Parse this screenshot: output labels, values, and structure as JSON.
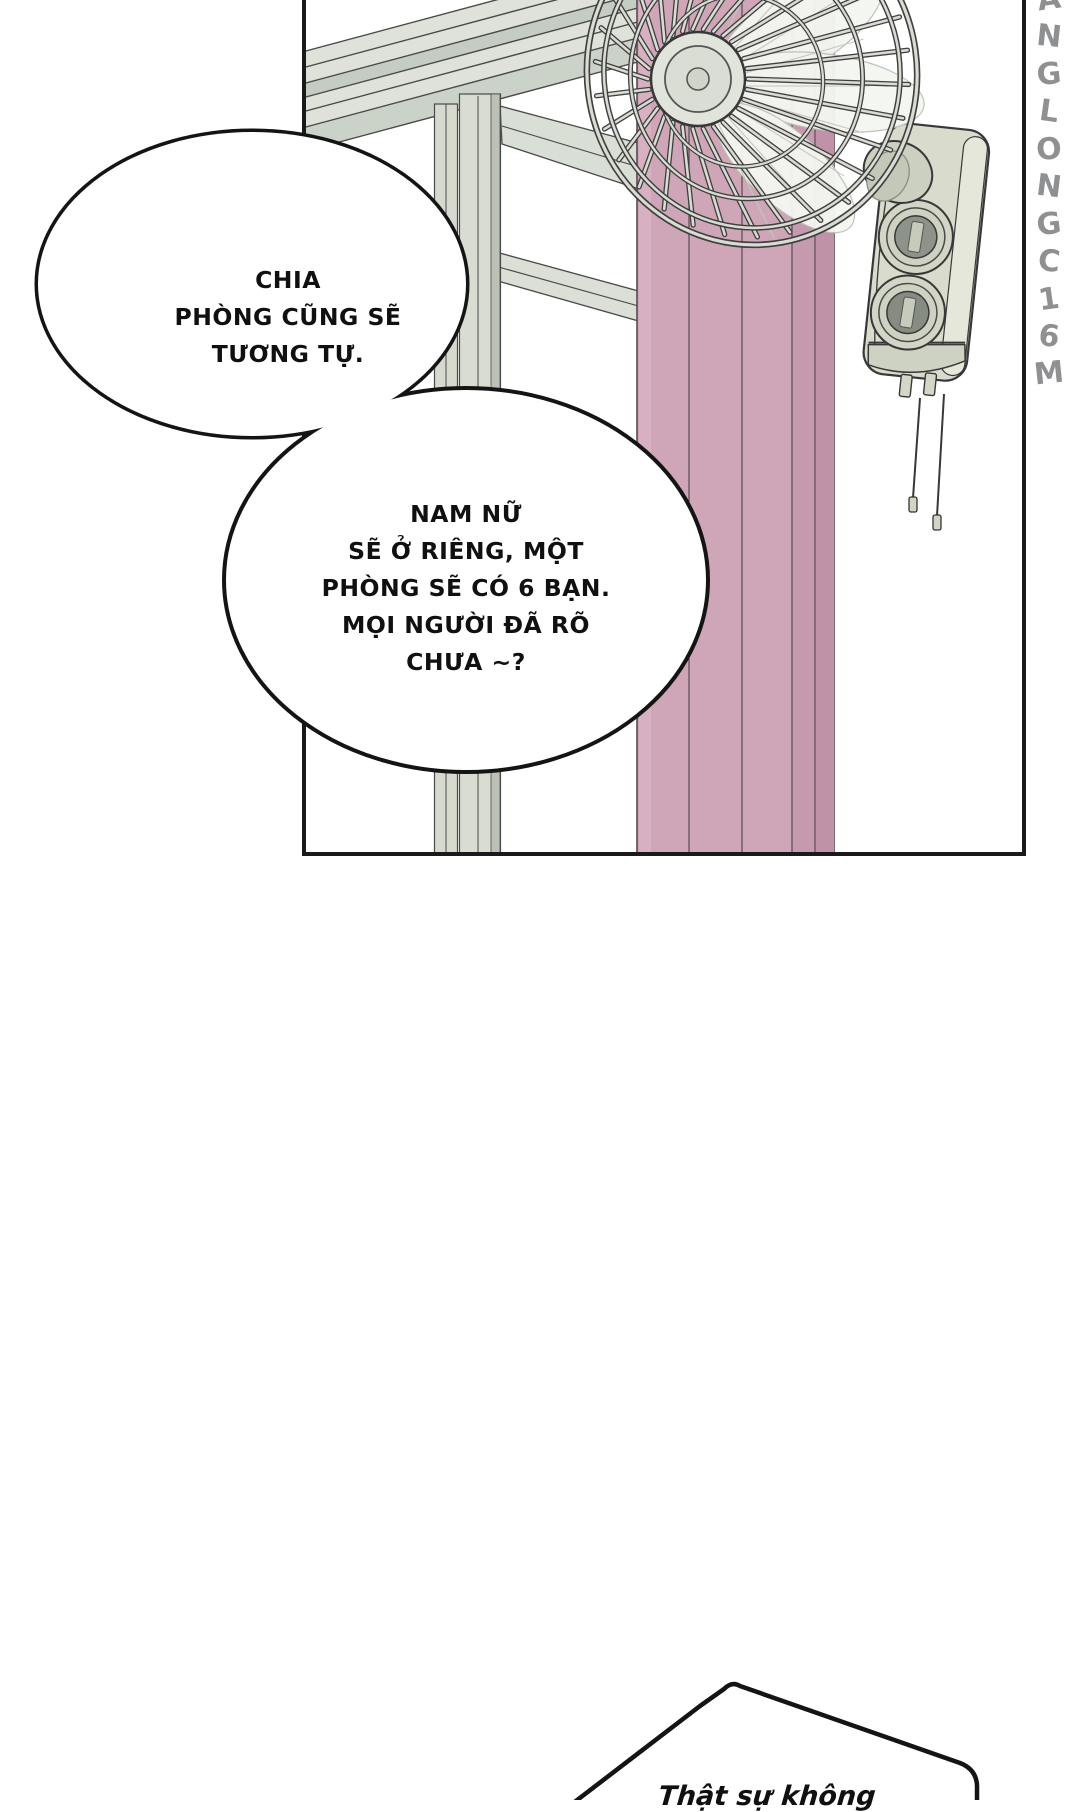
{
  "bubbles": {
    "b1": {
      "lines": [
        "CHIA",
        "PHÒNG CŨNG SẼ",
        "TƯƠNG TỰ."
      ]
    },
    "b2": {
      "lines": [
        "NAM NỮ",
        "SẼ Ở RIÊNG, MỘT",
        "PHÒNG SẼ CÓ 6 BẠN.",
        "MỌI NGƯỜI ĐÃ RÕ",
        "CHƯA ~?"
      ]
    },
    "b3": {
      "lines": [
        "Thật sự không"
      ]
    }
  },
  "watermark": {
    "text": "ANGLONGC16M",
    "letters": [
      "A",
      "N",
      "G",
      "L",
      "O",
      "N",
      "G",
      "C",
      "1",
      "6",
      "M"
    ],
    "color": "#8e9092"
  },
  "art": {
    "colors": {
      "outline": "#3a3a3a",
      "panel_border": "#1a1a1a",
      "metal_light": "#dee2d9",
      "metal_mid": "#d8dcd1",
      "metal_dark": "#bbc2b5",
      "curtain": "#cfa5b8",
      "curtain_dark": "#c69aae",
      "curtain_edge": "#5a4a53",
      "bubble_fill": "#ffffff",
      "bubble_stroke": "#141414"
    }
  }
}
